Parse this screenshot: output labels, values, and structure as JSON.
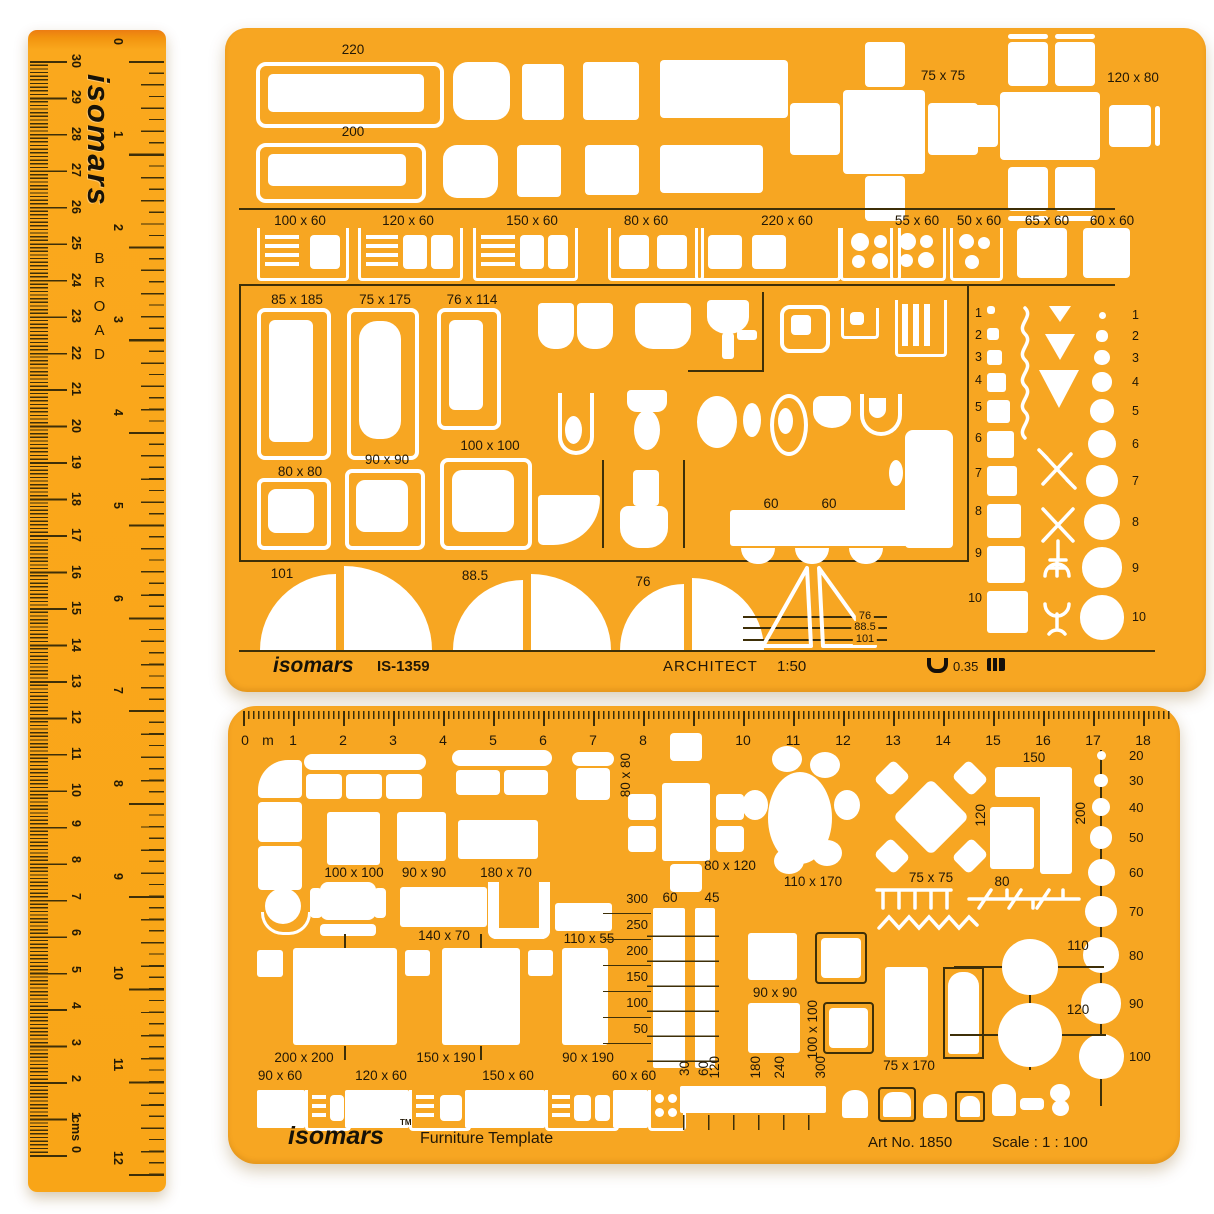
{
  "colors": {
    "template_orange": "#F7A622",
    "ruler_orange": "#F9A517",
    "ruler_top_edge": "#EC7D12",
    "cutout_white": "#FFFFFF",
    "ink": "#221806",
    "line_dark": "#3E2F08"
  },
  "ruler": {
    "brand": "isomars",
    "series": "BROAD",
    "cm_unit": "cms",
    "cm_zero": "0",
    "cm_numbers": [
      "30",
      "29",
      "28",
      "27",
      "26",
      "25",
      "24",
      "23",
      "22",
      "21",
      "20",
      "19",
      "18",
      "17",
      "16",
      "15",
      "14",
      "13",
      "12",
      "11",
      "10",
      "9",
      "8",
      "7",
      "6",
      "5",
      "4",
      "3",
      "2",
      "1"
    ],
    "inch_numbers": [
      "0",
      "1",
      "2",
      "3",
      "4",
      "5",
      "6",
      "7",
      "8",
      "9",
      "10",
      "11",
      "12"
    ]
  },
  "arch": {
    "brand": "isomars",
    "model": "IS-1359",
    "title": "ARCHITECT",
    "scale": "1:50",
    "pen_width": "0.35",
    "bed1": "220",
    "bed2": "200",
    "table_small": "75 x 75",
    "table_large": "120 x 80",
    "desk_row": [
      "100 x 60",
      "120 x 60",
      "150 x 60",
      "80 x 60",
      "220 x 60",
      "55 x 60",
      "50 x 60",
      "65 x 60",
      "60 x 60"
    ],
    "tubs": [
      "85 x 185",
      "75 x 175",
      "76 x 114"
    ],
    "showers": [
      "80 x 80",
      "90 x 90",
      "100 x 100"
    ],
    "seats": [
      "60",
      "60"
    ],
    "square_numbers": [
      "1",
      "2",
      "3",
      "4",
      "5",
      "6",
      "7",
      "8",
      "9",
      "10"
    ],
    "circle_numbers": [
      "1",
      "2",
      "3",
      "4",
      "5",
      "6",
      "7",
      "8",
      "9",
      "10"
    ],
    "arc1": "101",
    "arc2": "88.5",
    "arc3": "76",
    "tri_lines": [
      "76",
      "88.5",
      "101"
    ]
  },
  "furn": {
    "brand": "isomars",
    "tm": "TM",
    "title": "Furniture Template",
    "art_no": "Art No. 1850",
    "scale": "Scale : 1 : 100",
    "scale_zero": "0",
    "scale_unit": "m",
    "scale_numbers": [
      "1",
      "2",
      "3",
      "4",
      "5",
      "6",
      "7",
      "8",
      "9",
      "10",
      "11",
      "12",
      "13",
      "14",
      "15",
      "16",
      "17",
      "18"
    ],
    "sofa_v": "80 x 80",
    "cross_table": "80 x 120",
    "oval_table": "110 x 170",
    "diamond_table": "75 x 75",
    "counter_len": "150",
    "counter_depth": "120",
    "counter_w": "80",
    "counter_side": "200",
    "armchair": "100 x 100",
    "sq90": "90 x 90",
    "rect180": "180 x 70",
    "rect140": "140 x 70",
    "rect110": "110 x 55",
    "bed_large": "200 x 200",
    "bed_medium": "150 x 190",
    "bed_single": "90 x 190",
    "sq90b": "90 x 90",
    "window_v": "100 x 100",
    "door": "75 x 170",
    "circle110": "110",
    "circle120": "120",
    "ladder_values": [
      "300",
      "250",
      "200",
      "150",
      "100",
      "50"
    ],
    "ladder_col1": "60",
    "ladder_col2": "45",
    "circle_values": [
      "20",
      "30",
      "40",
      "50",
      "60",
      "70",
      "80",
      "90",
      "100"
    ],
    "kitchen_row": [
      "90 x 60",
      "120 x 60",
      "150 x 60",
      "60 x 60"
    ],
    "kitchen_v1": "30",
    "kitchen_v2": "60",
    "bottom_vertical": [
      "120",
      "180",
      "240",
      "300"
    ]
  }
}
